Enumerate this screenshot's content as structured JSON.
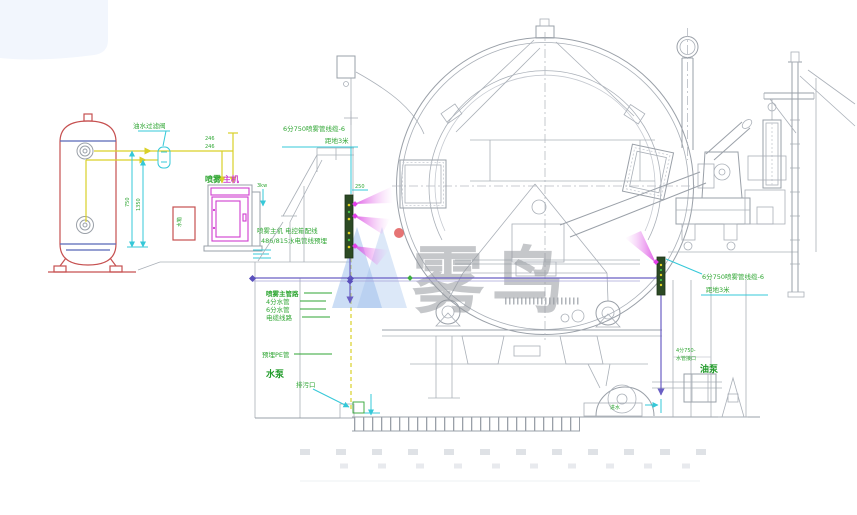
{
  "page": {
    "background": "#ffffff",
    "corner_blob_color": "#f2f6fd"
  },
  "watermark": {
    "text": "雾鸟",
    "logo": "wuniao-logo",
    "logo_blue": "#98bce9",
    "dot_red": "#e25c5c",
    "text_gray": "#97999e"
  },
  "colors": {
    "tank_red": "#c65050",
    "weld_blue": "#5868b8",
    "pipe_yellow": "#d9d028",
    "dim_cyan": "#35c8d8",
    "label_green": "#2fa633",
    "cabinet_magenta": "#cf3ccf",
    "spray_magenta": "#d83fe0",
    "route_purple": "#6a5fc4",
    "line_gray": "#9aa0a8"
  },
  "labels": {
    "filter_label": "油水过滤阀",
    "riser_dim_top": "246",
    "riser_dim_bot": "246",
    "dim_height_1": "750",
    "dim_height_2": "1350",
    "water_box_label": "水箱",
    "cabinet_label_green": "喷雾",
    "cabinet_label_magenta": "主机",
    "cabinet_power": "3kw",
    "note_line1": "喷雾主机 电控箱配线",
    "note_line2": "486/815水电管线预埋",
    "left_riser_line1": "6分750喷雾管线缆-6",
    "left_riser_line2": "距地3米",
    "manifold_dim": "250",
    "list_item_1": "喷雾主管路",
    "list_item_2": "4分水管",
    "list_item_3": "6分水管",
    "list_item_4": "电缆线路",
    "pit_label": "预埋PE管",
    "pump_label_bold": "水泵",
    "drain_label": "排污口",
    "right_riser_line1": "6分750喷雾管线缆-6",
    "right_riser_line2": "距地3米",
    "right_pipe_line1": "4分750-",
    "right_pipe_line2": "水管接口",
    "oil_pump_label": "油泵",
    "pump_inlet_label": "进水"
  }
}
